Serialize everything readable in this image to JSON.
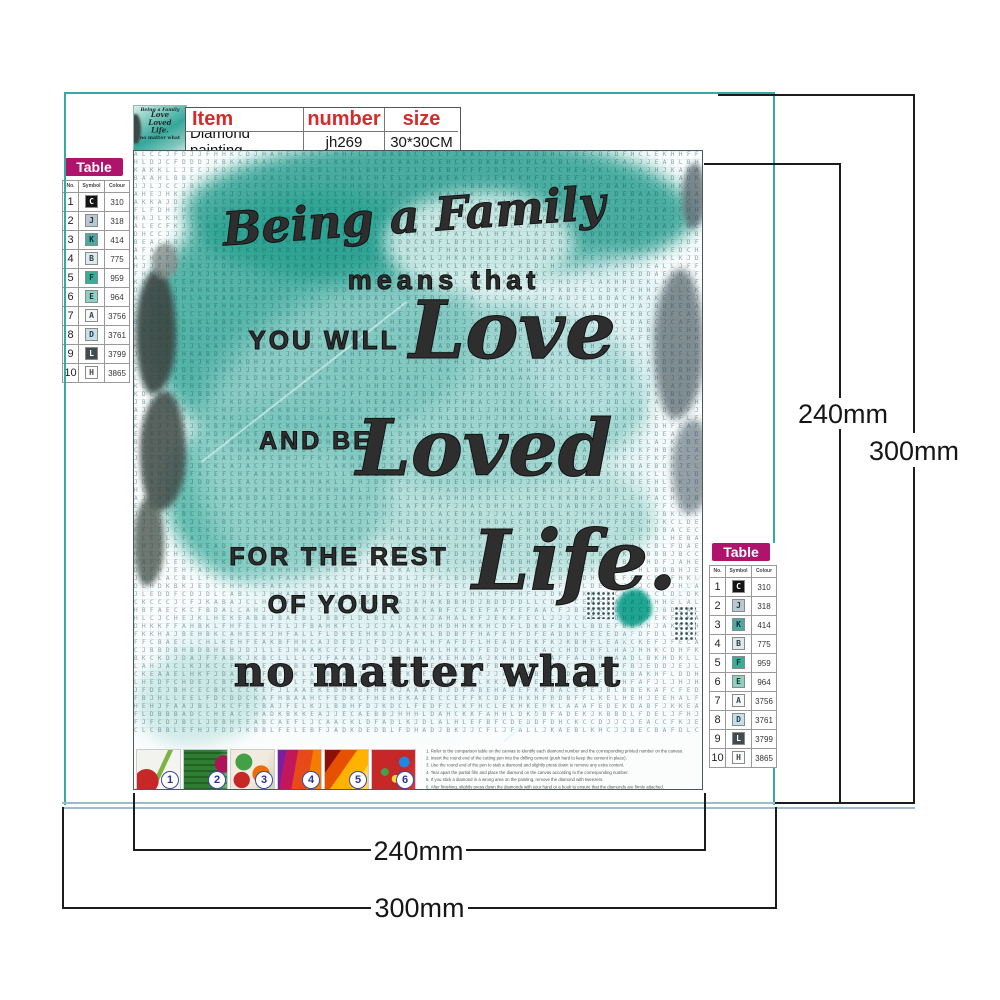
{
  "product_table": {
    "headers": [
      "Item",
      "number",
      "size"
    ],
    "row": [
      "Diamond painting",
      "jh269",
      "30*30CM"
    ]
  },
  "color_table": {
    "title": "Table",
    "headers": [
      "No.",
      "Symbol",
      "Colour"
    ],
    "rows": [
      {
        "no": "1",
        "symbol": "C",
        "colour": "310",
        "bg": "#141414",
        "fg": "#ffffff"
      },
      {
        "no": "2",
        "symbol": "J",
        "colour": "318",
        "bg": "#b9c9d3",
        "fg": "#24343c"
      },
      {
        "no": "3",
        "symbol": "K",
        "colour": "414",
        "bg": "#4fa9a2",
        "fg": "#10302e"
      },
      {
        "no": "4",
        "symbol": "B",
        "colour": "775",
        "bg": "#dce9ef",
        "fg": "#2a3a42"
      },
      {
        "no": "5",
        "symbol": "F",
        "colour": "959",
        "bg": "#33af9a",
        "fg": "#0e312b"
      },
      {
        "no": "6",
        "symbol": "E",
        "colour": "964",
        "bg": "#8fd0c5",
        "fg": "#173733"
      },
      {
        "no": "7",
        "symbol": "A",
        "colour": "3756",
        "bg": "#f4f7f6",
        "fg": "#33434a"
      },
      {
        "no": "8",
        "symbol": "D",
        "colour": "3761",
        "bg": "#c6dfe9",
        "fg": "#24404c"
      },
      {
        "no": "9",
        "symbol": "L",
        "colour": "3799",
        "bg": "#414c50",
        "fg": "#ffffff"
      },
      {
        "no": "10",
        "symbol": "H",
        "colour": "3865",
        "bg": "#fbfbf8",
        "fg": "#3a4a50"
      }
    ]
  },
  "quote": [
    "Being a Family",
    "means that",
    "YOU WILL",
    "Love",
    "AND BE",
    "Loved",
    "FOR THE REST",
    "Life.",
    "OF YOUR",
    "no matter what"
  ],
  "dimensions": {
    "right_inner": "240mm",
    "right_outer": "300mm",
    "bottom_inner": "240mm",
    "bottom_outer": "300mm"
  },
  "steps": {
    "labels": [
      "1",
      "2",
      "3",
      "4",
      "5",
      "6"
    ]
  },
  "instructions": [
    "1. Refer to the comparison table on the canvas to identify each diamond number and the corresponding printed number on the canvas.",
    "2. Insert the round end of the cutting pen into the drilling cement (push hard to keep the cement in place).",
    "3. Use the round end of the pen to stab a diamond and slightly press down to remove any extra content.",
    "4. Tear apart the partial film and place the diamond on the canvas according to the corresponding number.",
    "5. If you stick a diamond in a wrong area on the painting, remove the diamond with tweezers.",
    "6. After finishing, slightly press down the diamonds with your hand or a book to ensure that the diamonds are firmly attached."
  ],
  "canvas": {
    "grid_symbols": [
      "A",
      "B",
      "C",
      "D",
      "E",
      "F",
      "H",
      "J",
      "K",
      "L"
    ]
  },
  "colors": {
    "accent_red": "#d42b2b",
    "badge_magenta": "#b0136b",
    "teal_frame": "#35aaa2",
    "light_blue_rule": "#9cbdd0",
    "canvas_teal_wash": "#2fa896",
    "dimension_line": "#1c1c1c"
  }
}
